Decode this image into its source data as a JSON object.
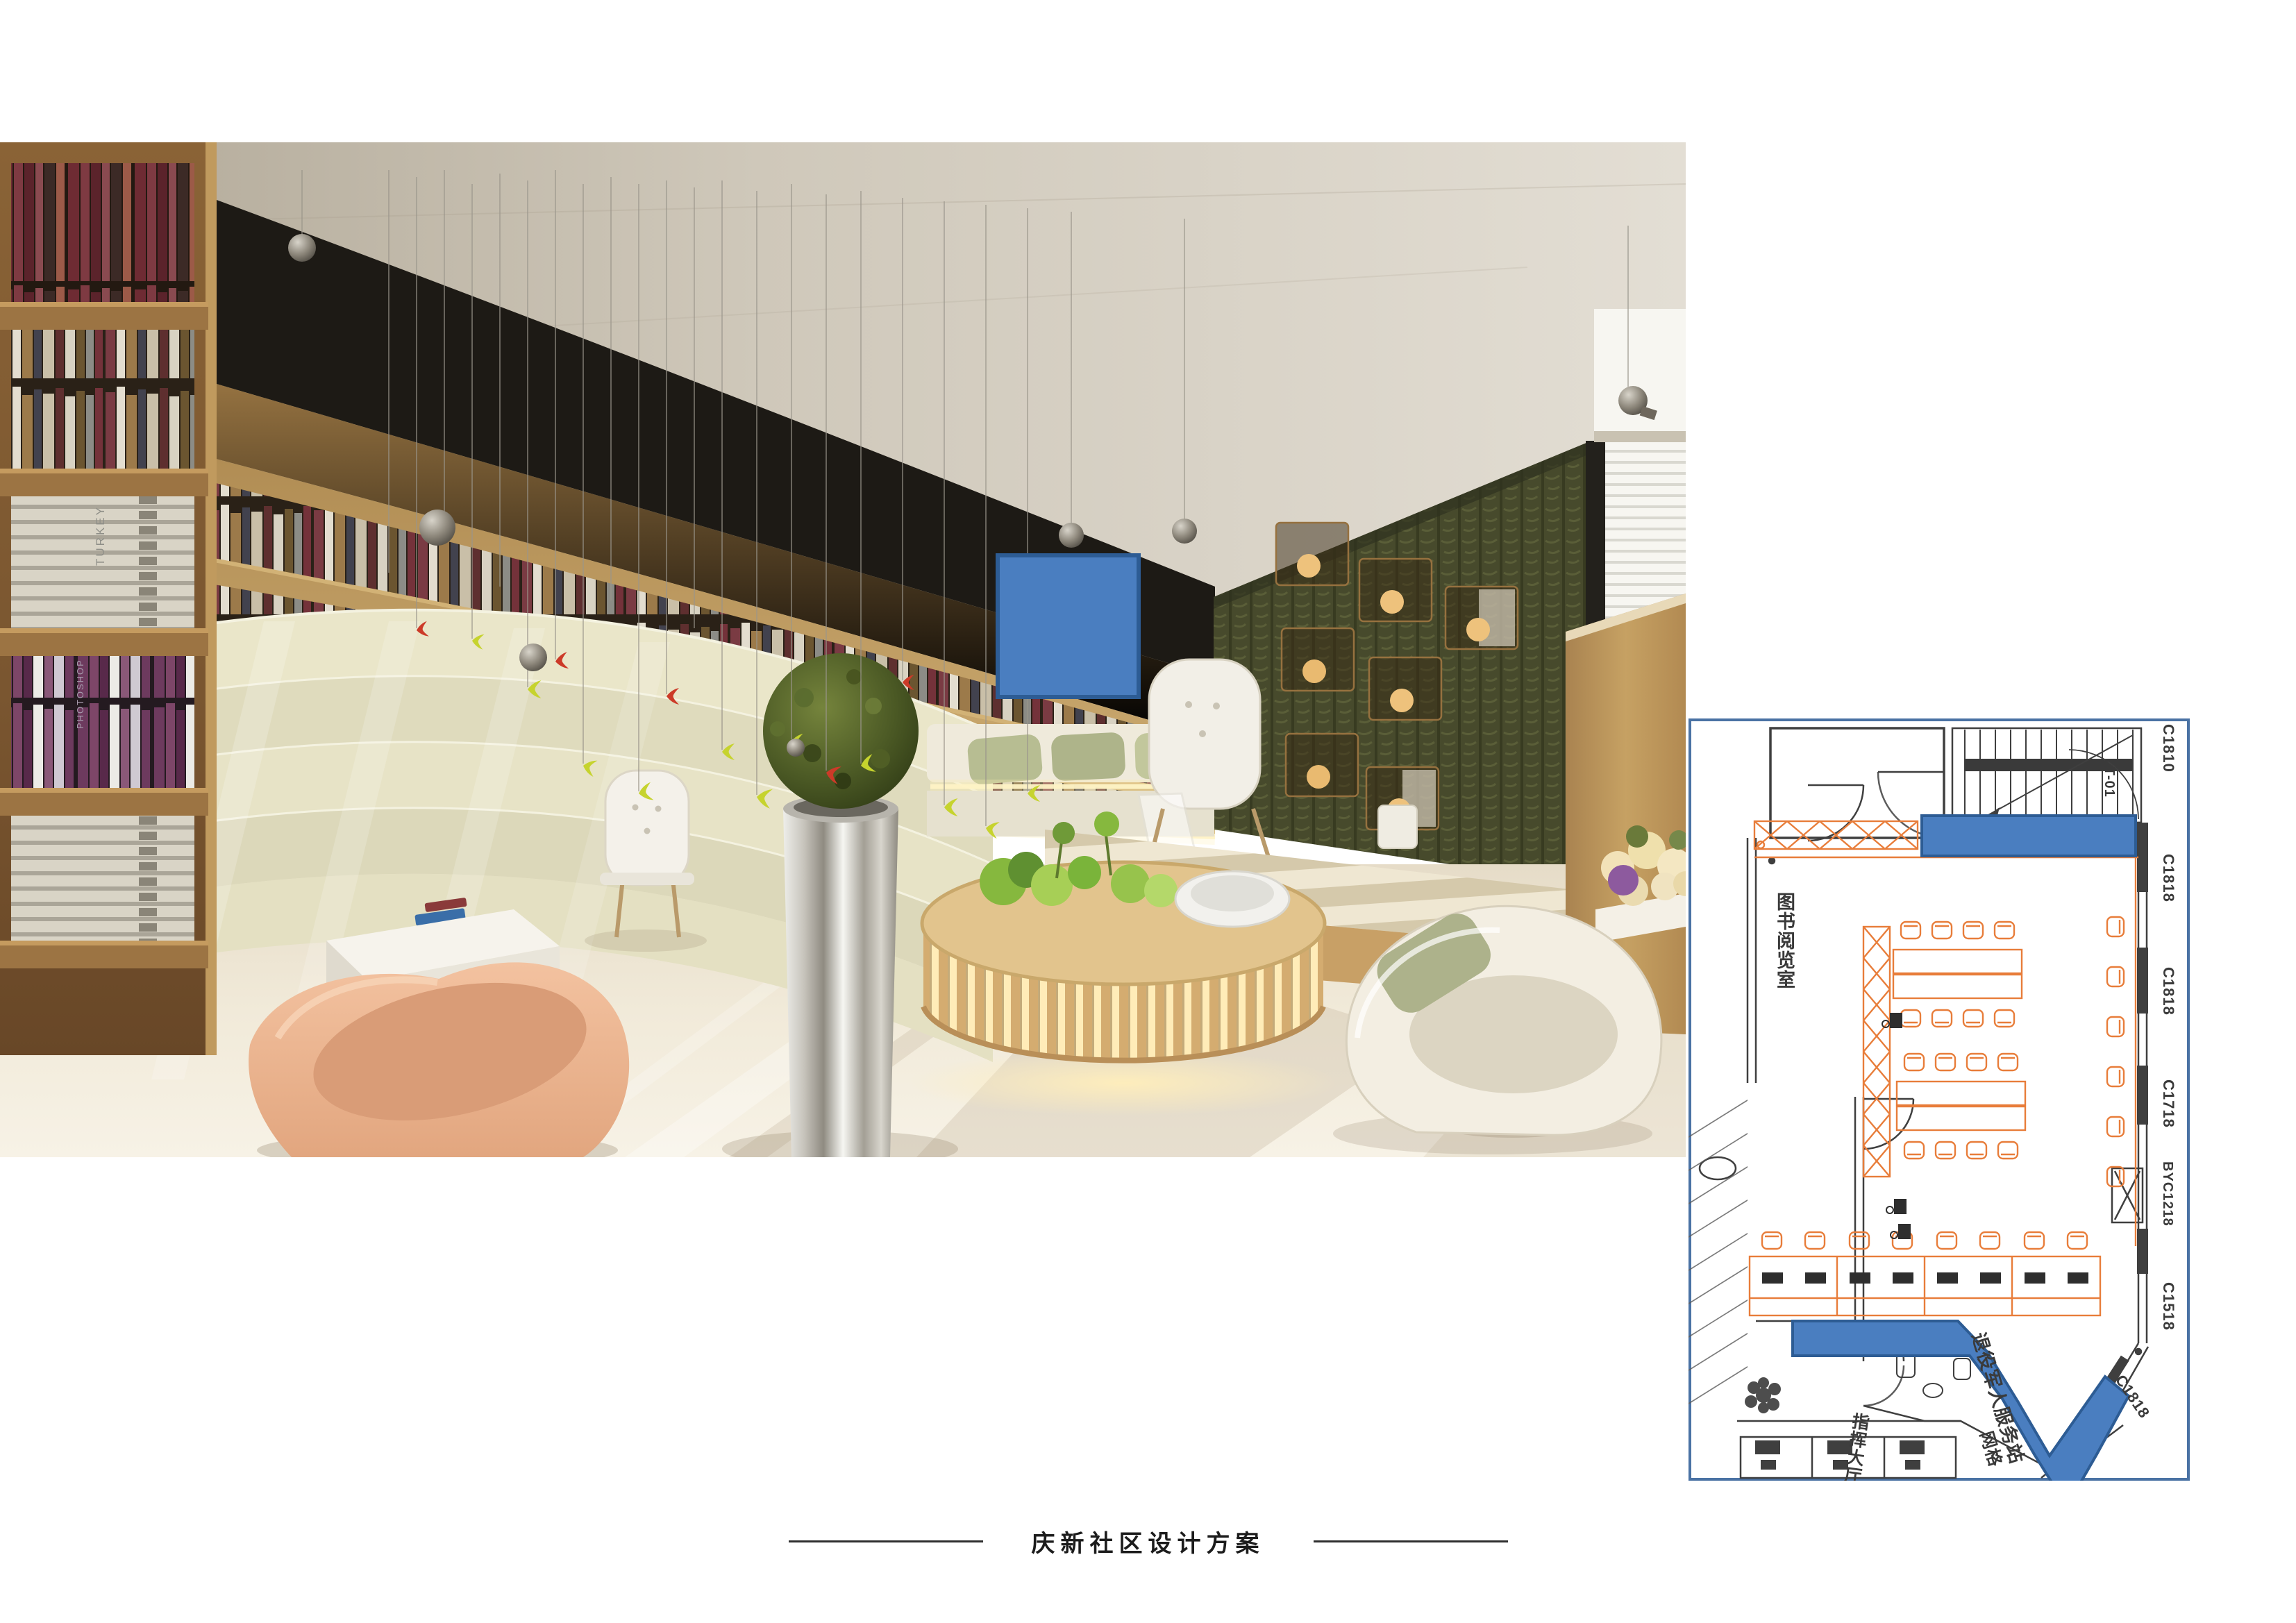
{
  "footer": {
    "title": "庆新社区设计方案"
  },
  "render": {
    "book_spines": {
      "spine_1": "TURKEY",
      "spine_2": "PHOTOSHOP"
    }
  },
  "plan": {
    "room_labels": {
      "reading_room": "图书阅览室",
      "veterans_station": "退役军人服务站",
      "command_hall": "指挥大厅",
      "grid_room": "网格"
    },
    "window_labels": [
      "C1810",
      "LT-01",
      "C1818",
      "C1818",
      "C1718",
      "BYC1218",
      "C1518",
      "C1818"
    ]
  },
  "colors": {
    "highlight_blue": "#4a7ec0",
    "highlight_blue_border": "#2d5c94",
    "plan_orange": "#e87d3a",
    "plan_wall": "#3f3f3f",
    "plan_border": "#4a72a4"
  }
}
